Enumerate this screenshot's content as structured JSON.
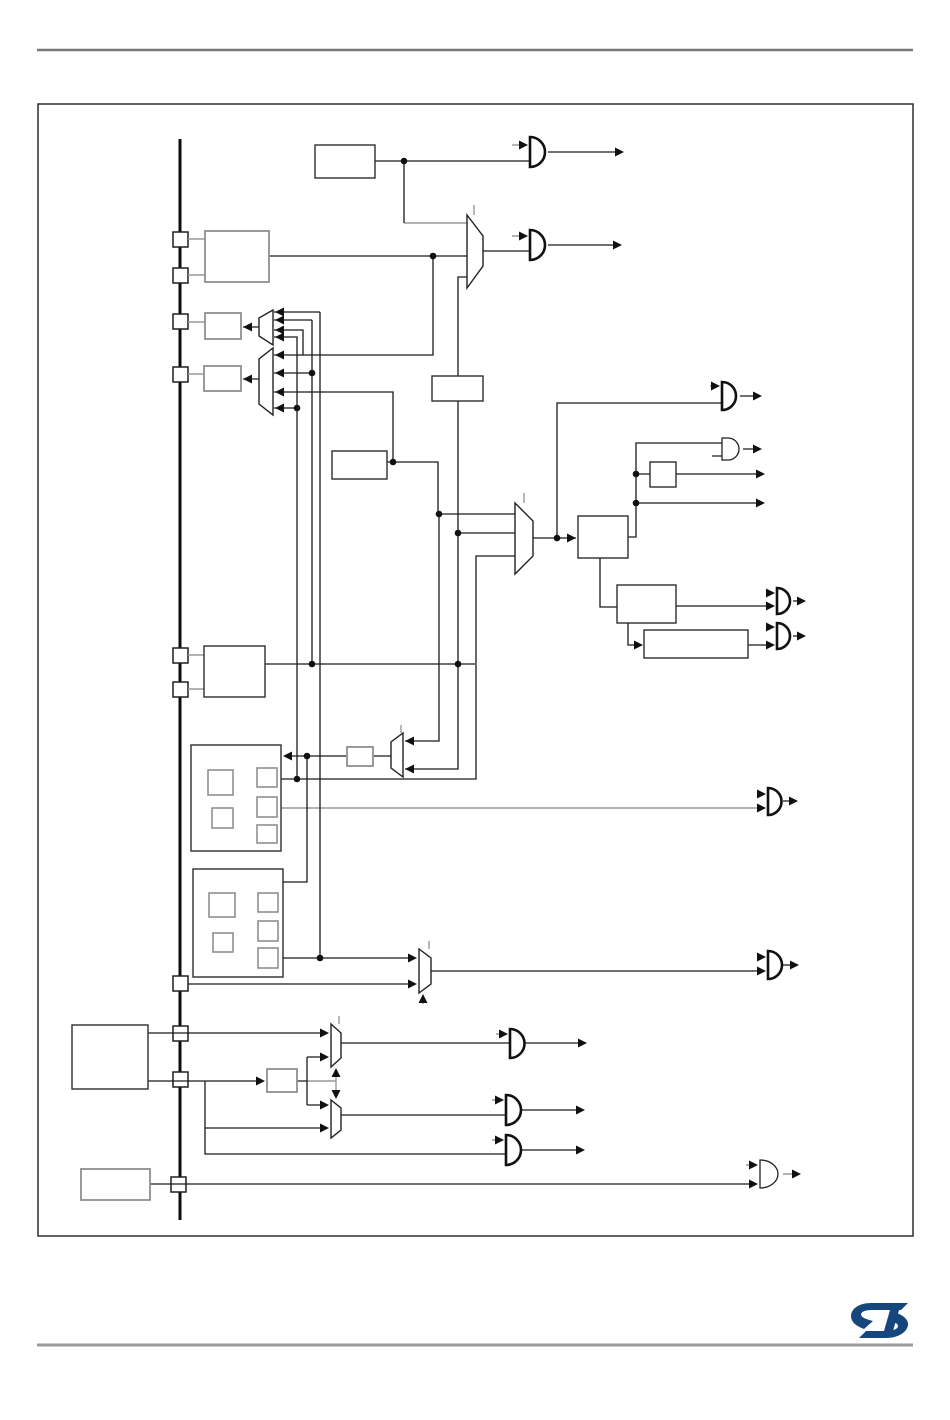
{
  "page": {
    "background": "#ffffff",
    "top_rule_color": "#787878",
    "bottom_rule_color": "#9a9a9a",
    "frame_color": "#2e2e2e"
  },
  "figure": {
    "kind": "clock-tree-block-diagram",
    "labels_visible": false,
    "wire_color": "#1a1a1a",
    "secondary_wire_color": "#9a9a9a",
    "box_fill": "#ffffff",
    "bus_tap_count": 10,
    "and_gate_count": 12,
    "mux_count": 8,
    "junction_dot_count": 15
  },
  "footer": {
    "logo": "ST-logo",
    "logo_color": "#16477c"
  }
}
